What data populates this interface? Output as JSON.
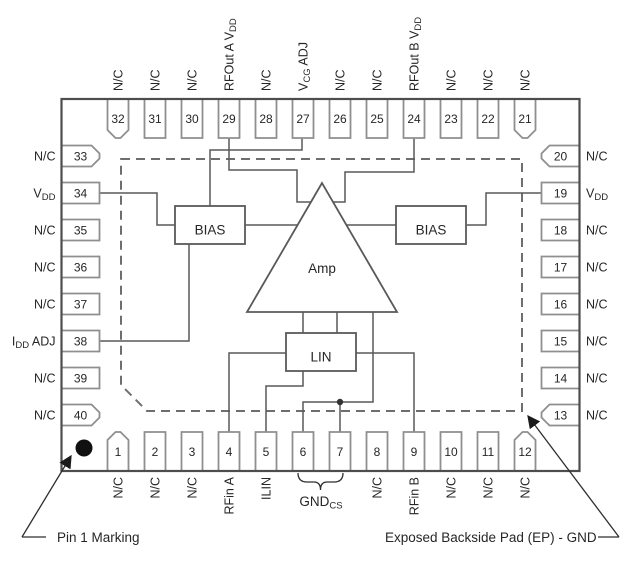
{
  "pins": {
    "top": [
      {
        "num": "32",
        "label": "N/C"
      },
      {
        "num": "31",
        "label": "N/C"
      },
      {
        "num": "30",
        "label": "N/C"
      },
      {
        "num": "29",
        "label": "RFOut A V~DD~"
      },
      {
        "num": "28",
        "label": "N/C"
      },
      {
        "num": "27",
        "label": "V~CG~ ADJ"
      },
      {
        "num": "26",
        "label": "N/C"
      },
      {
        "num": "25",
        "label": "N/C"
      },
      {
        "num": "24",
        "label": "RFOut B V~DD~"
      },
      {
        "num": "23",
        "label": "N/C"
      },
      {
        "num": "22",
        "label": "N/C"
      },
      {
        "num": "21",
        "label": "N/C"
      }
    ],
    "bottom": [
      {
        "num": "1",
        "label": "N/C"
      },
      {
        "num": "2",
        "label": "N/C"
      },
      {
        "num": "3",
        "label": "N/C"
      },
      {
        "num": "4",
        "label": "RFin A"
      },
      {
        "num": "5",
        "label": "ILIN"
      },
      {
        "num": "6",
        "label": ""
      },
      {
        "num": "7",
        "label": ""
      },
      {
        "num": "8",
        "label": "N/C"
      },
      {
        "num": "9",
        "label": "RFin B"
      },
      {
        "num": "10",
        "label": "N/C"
      },
      {
        "num": "11",
        "label": "N/C"
      },
      {
        "num": "12",
        "label": "N/C"
      }
    ],
    "left": [
      {
        "num": "33",
        "label": "N/C"
      },
      {
        "num": "34",
        "label": "V~DD~"
      },
      {
        "num": "35",
        "label": "N/C"
      },
      {
        "num": "36",
        "label": "N/C"
      },
      {
        "num": "37",
        "label": "N/C"
      },
      {
        "num": "38",
        "label": "I~DD~ ADJ"
      },
      {
        "num": "39",
        "label": "N/C"
      },
      {
        "num": "40",
        "label": "N/C"
      }
    ],
    "right": [
      {
        "num": "20",
        "label": "N/C"
      },
      {
        "num": "19",
        "label": "V~DD~"
      },
      {
        "num": "18",
        "label": "N/C"
      },
      {
        "num": "17",
        "label": "N/C"
      },
      {
        "num": "16",
        "label": "N/C"
      },
      {
        "num": "15",
        "label": "N/C"
      },
      {
        "num": "14",
        "label": "N/C"
      },
      {
        "num": "13",
        "label": "N/C"
      }
    ]
  },
  "blocks": {
    "bias_left": "BIAS",
    "bias_right": "BIAS",
    "amp": "Amp",
    "lin": "LIN"
  },
  "annotations": {
    "pin1_marking": "Pin 1 Marking",
    "exposed_pad": "Exposed Backside Pad (EP) - GND",
    "gnd_cs": "GND~CS~"
  },
  "colors": {
    "outline": "#4d4d4d",
    "pin_border": "#8f8f8f",
    "wire": "#595959",
    "dashed": "#6e6e6e",
    "text": "#262626"
  }
}
